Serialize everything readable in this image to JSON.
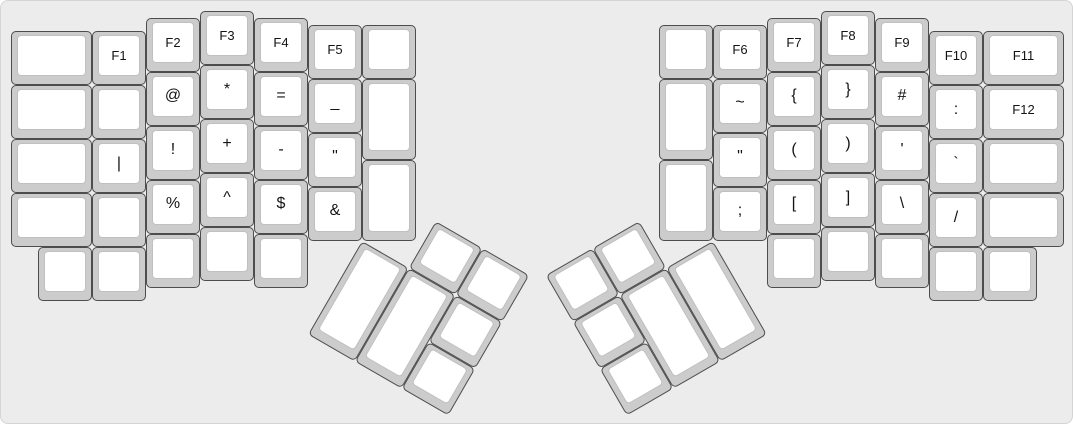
{
  "board": {
    "width": 1073,
    "height": 424,
    "background": "#ececec",
    "border_color": "#d4d4d4",
    "key_side_color": "#cccccc",
    "key_top_color": "#ffffff",
    "key_border_color": "#4d4d4d",
    "cap_border_color": "#c0c0c0",
    "legend_color": "#141414"
  },
  "unit": 54,
  "margin": 10,
  "groups": [
    {
      "name": "left-main",
      "r": 0,
      "rx": 0,
      "ry": 0,
      "keys": [
        {
          "x": 0,
          "y": 0.375,
          "w": 1.5,
          "t": "",
          "n": "blank"
        },
        {
          "x": 1.5,
          "y": 0.375,
          "t": "F1",
          "n": "f1"
        },
        {
          "x": 2.5,
          "y": 0.125,
          "t": "F2",
          "n": "f2"
        },
        {
          "x": 3.5,
          "y": 0,
          "t": "F3",
          "n": "f3"
        },
        {
          "x": 4.5,
          "y": 0.125,
          "t": "F4",
          "n": "f4"
        },
        {
          "x": 5.5,
          "y": 0.25,
          "t": "F5",
          "n": "f5"
        },
        {
          "x": 6.5,
          "y": 0.25,
          "t": "",
          "n": "blank"
        },
        {
          "x": 0,
          "y": 1.375,
          "w": 1.5,
          "t": "",
          "n": "blank"
        },
        {
          "x": 1.5,
          "y": 1.375,
          "t": "",
          "n": "blank"
        },
        {
          "x": 2.5,
          "y": 1.125,
          "t": "@",
          "n": "at"
        },
        {
          "x": 3.5,
          "y": 1,
          "t": "*",
          "n": "asterisk"
        },
        {
          "x": 4.5,
          "y": 1.125,
          "t": "=",
          "n": "equals"
        },
        {
          "x": 5.5,
          "y": 1.25,
          "t": "_",
          "n": "underscore"
        },
        {
          "x": 6.5,
          "y": 1.25,
          "h": 1.5,
          "t": "",
          "n": "blank"
        },
        {
          "x": 0,
          "y": 2.375,
          "w": 1.5,
          "t": "",
          "n": "blank"
        },
        {
          "x": 1.5,
          "y": 2.375,
          "t": "|",
          "n": "pipe"
        },
        {
          "x": 2.5,
          "y": 2.125,
          "t": "!",
          "n": "exclamation"
        },
        {
          "x": 3.5,
          "y": 2,
          "t": "+",
          "n": "plus"
        },
        {
          "x": 4.5,
          "y": 2.125,
          "t": "-",
          "n": "minus"
        },
        {
          "x": 5.5,
          "y": 2.25,
          "t": "\"",
          "n": "double-quote"
        },
        {
          "x": 0,
          "y": 3.375,
          "w": 1.5,
          "t": "",
          "n": "blank"
        },
        {
          "x": 1.5,
          "y": 3.375,
          "t": "",
          "n": "blank"
        },
        {
          "x": 2.5,
          "y": 3.125,
          "t": "%",
          "n": "percent"
        },
        {
          "x": 3.5,
          "y": 3,
          "t": "^",
          "n": "caret"
        },
        {
          "x": 4.5,
          "y": 3.125,
          "t": "$",
          "n": "dollar"
        },
        {
          "x": 5.5,
          "y": 3.25,
          "t": "&",
          "n": "ampersand"
        },
        {
          "x": 6.5,
          "y": 2.75,
          "h": 1.5,
          "t": "",
          "n": "blank"
        },
        {
          "x": 0.5,
          "y": 4.375,
          "t": "",
          "n": "blank"
        },
        {
          "x": 1.5,
          "y": 4.375,
          "t": "",
          "n": "blank"
        },
        {
          "x": 2.5,
          "y": 4.125,
          "t": "",
          "n": "blank"
        },
        {
          "x": 3.5,
          "y": 4,
          "t": "",
          "n": "blank"
        },
        {
          "x": 4.5,
          "y": 4.125,
          "t": "",
          "n": "blank"
        }
      ]
    },
    {
      "name": "right-main",
      "r": 0,
      "rx": 0,
      "ry": 0,
      "keys": [
        {
          "x": 12,
          "y": 0.25,
          "t": "",
          "n": "blank"
        },
        {
          "x": 13,
          "y": 0.25,
          "t": "F6",
          "n": "f6"
        },
        {
          "x": 14,
          "y": 0.125,
          "t": "F7",
          "n": "f7"
        },
        {
          "x": 15,
          "y": 0,
          "t": "F8",
          "n": "f8"
        },
        {
          "x": 16,
          "y": 0.125,
          "t": "F9",
          "n": "f9"
        },
        {
          "x": 17,
          "y": 0.375,
          "t": "F10",
          "n": "f10"
        },
        {
          "x": 18,
          "y": 0.375,
          "w": 1.5,
          "t": "F11",
          "n": "f11"
        },
        {
          "x": 12,
          "y": 1.25,
          "h": 1.5,
          "t": "",
          "n": "blank"
        },
        {
          "x": 13,
          "y": 1.25,
          "t": "~",
          "n": "tilde"
        },
        {
          "x": 14,
          "y": 1.125,
          "t": "{",
          "n": "open-brace"
        },
        {
          "x": 15,
          "y": 1,
          "t": "}",
          "n": "close-brace"
        },
        {
          "x": 16,
          "y": 1.125,
          "t": "#",
          "n": "hash"
        },
        {
          "x": 17,
          "y": 1.375,
          "t": ":",
          "n": "colon"
        },
        {
          "x": 18,
          "y": 1.375,
          "w": 1.5,
          "t": "F12",
          "n": "f12"
        },
        {
          "x": 13,
          "y": 2.25,
          "t": "\"",
          "n": "double-quote"
        },
        {
          "x": 14,
          "y": 2.125,
          "t": "(",
          "n": "open-paren"
        },
        {
          "x": 15,
          "y": 2,
          "t": ")",
          "n": "close-paren"
        },
        {
          "x": 16,
          "y": 2.125,
          "t": "'",
          "n": "apostrophe"
        },
        {
          "x": 17,
          "y": 2.375,
          "t": "`",
          "n": "backtick"
        },
        {
          "x": 18,
          "y": 2.375,
          "w": 1.5,
          "t": "",
          "n": "blank"
        },
        {
          "x": 12,
          "y": 2.75,
          "h": 1.5,
          "t": "",
          "n": "blank"
        },
        {
          "x": 13,
          "y": 3.25,
          "t": ";",
          "n": "semicolon"
        },
        {
          "x": 14,
          "y": 3.125,
          "t": "[",
          "n": "open-bracket"
        },
        {
          "x": 15,
          "y": 3,
          "t": "]",
          "n": "close-bracket"
        },
        {
          "x": 16,
          "y": 3.125,
          "t": "\\",
          "n": "backslash"
        },
        {
          "x": 17,
          "y": 3.375,
          "t": "/",
          "n": "slash"
        },
        {
          "x": 18,
          "y": 3.375,
          "w": 1.5,
          "t": "",
          "n": "blank"
        },
        {
          "x": 14,
          "y": 4.125,
          "t": "",
          "n": "blank"
        },
        {
          "x": 15,
          "y": 4,
          "t": "",
          "n": "blank"
        },
        {
          "x": 16,
          "y": 4.125,
          "t": "",
          "n": "blank"
        },
        {
          "x": 17,
          "y": 4.375,
          "t": "",
          "n": "blank"
        },
        {
          "x": 18,
          "y": 4.375,
          "t": "",
          "n": "blank"
        }
      ]
    },
    {
      "name": "left-thumb",
      "r": 30,
      "rx": 6.5,
      "ry": 4.25,
      "keys": [
        {
          "x": 1,
          "y": -1,
          "t": "",
          "n": "blank"
        },
        {
          "x": 2,
          "y": -1,
          "t": "",
          "n": "blank"
        },
        {
          "x": 0,
          "y": 0,
          "h": 2,
          "t": "",
          "n": "blank"
        },
        {
          "x": 1,
          "y": 0,
          "h": 2,
          "t": "",
          "n": "blank"
        },
        {
          "x": 2,
          "y": 0,
          "t": "",
          "n": "blank"
        },
        {
          "x": 2,
          "y": 1,
          "t": "",
          "n": "blank"
        }
      ]
    },
    {
      "name": "right-thumb",
      "r": -30,
      "rx": 13,
      "ry": 4.25,
      "keys": [
        {
          "x": -3,
          "y": -1,
          "t": "",
          "n": "blank"
        },
        {
          "x": -2,
          "y": -1,
          "t": "",
          "n": "blank"
        },
        {
          "x": -3,
          "y": 0,
          "t": "",
          "n": "blank"
        },
        {
          "x": -3,
          "y": 1,
          "t": "",
          "n": "blank"
        },
        {
          "x": -2,
          "y": 0,
          "h": 2,
          "t": "",
          "n": "blank"
        },
        {
          "x": -1,
          "y": 0,
          "h": 2,
          "t": "",
          "n": "blank"
        }
      ]
    }
  ]
}
